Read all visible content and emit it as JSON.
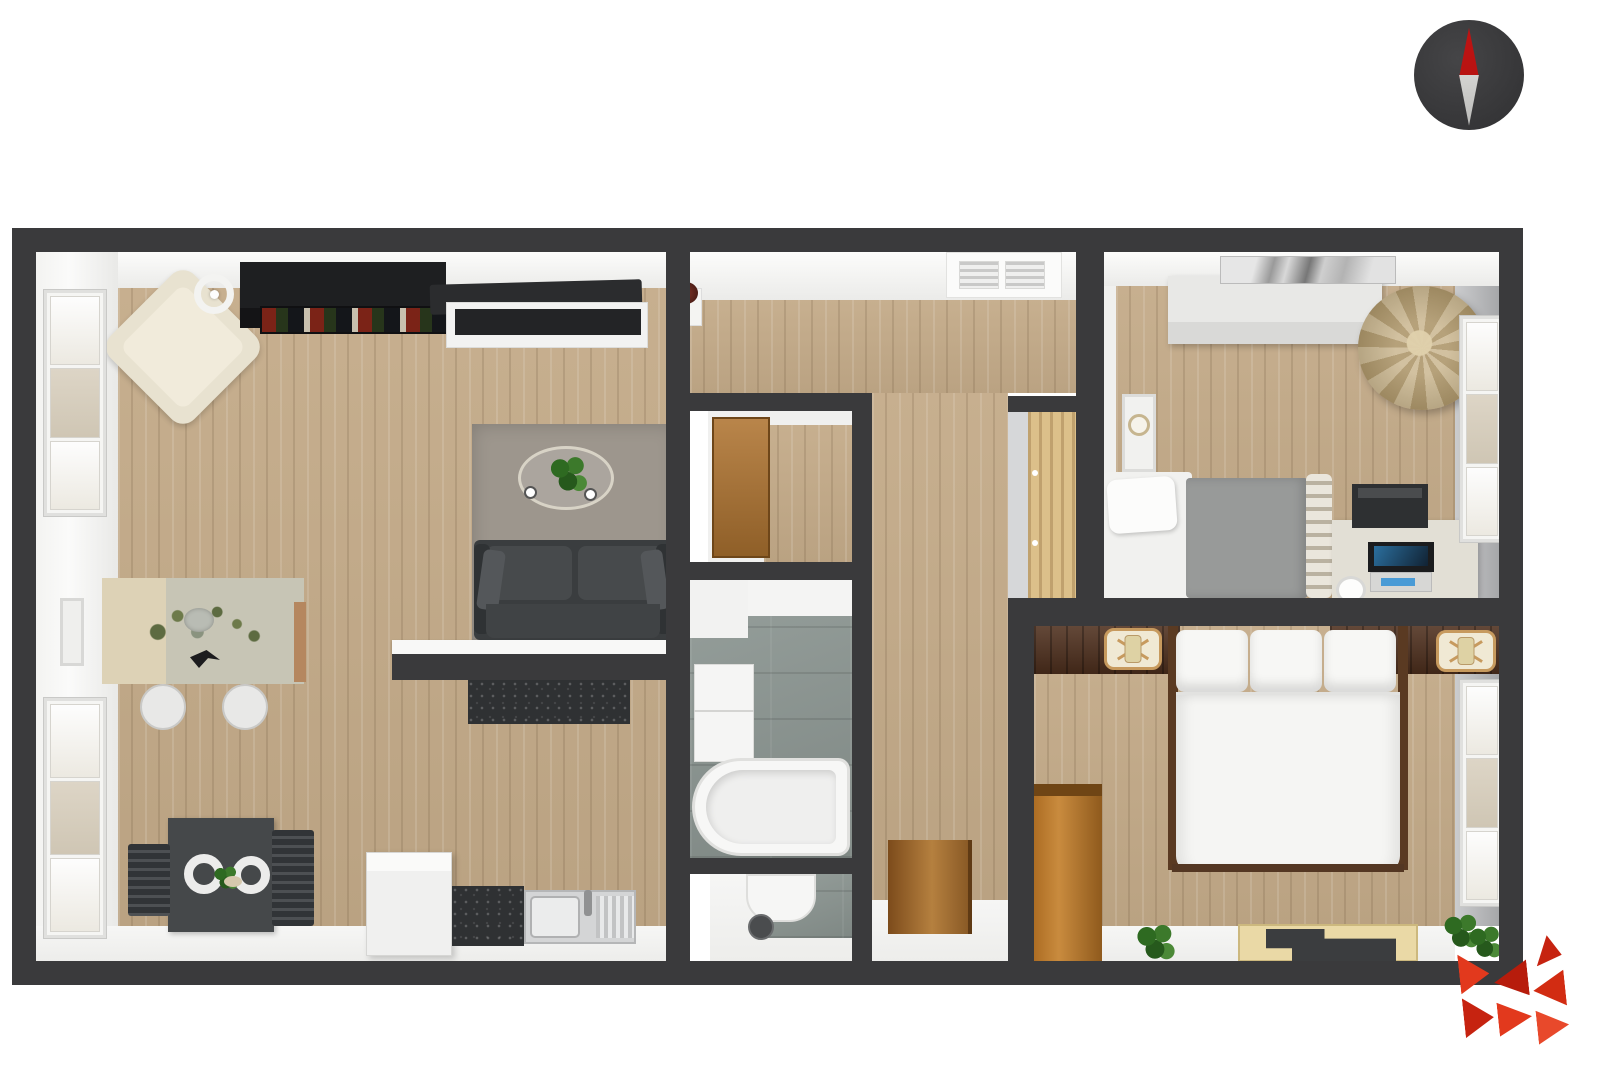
{
  "scene": {
    "description": "3D rendered top-down floor plan of a two-bedroom apartment, no text labels",
    "background_color": "#ffffff"
  },
  "palette": {
    "wall": "#3a3a3c",
    "wood": "#c4ab89",
    "tile": "#8d9793",
    "rug": "#9d968d",
    "sofa": "#3a3d3f",
    "cream": "#e8e2d0",
    "granite": "#2f3133",
    "nightstand": "#4e2f1d",
    "duvet": "#f5f5f3",
    "bean": "#9e8a61",
    "door-wood": "#a9763b",
    "accent-red": "#e2391d",
    "logo-dark": "#b71c0c",
    "compass-red": "#b01311",
    "compass-body": "#3a3a3c",
    "compass-south": "#d9d9d7"
  },
  "compass": {
    "body": "#3a3a3c",
    "north_needle": "#b01311",
    "south_needle": "#d9d9d7"
  },
  "logo": {
    "primary": "#e2391d",
    "dark": "#b71c0c"
  },
  "rooms": [
    {
      "id": "living-room",
      "furniture": [
        "armchair",
        "floor-lamp",
        "bookshelf",
        "tv",
        "tv-stand",
        "plant-stand",
        "area-rug",
        "coffee-table",
        "coffee-table-plant",
        "coffee-cups",
        "sofa",
        "breakfast-bar",
        "console-desk",
        "flower-vase",
        "bird-decor",
        "desk-chairs",
        "picture-frame",
        "windows"
      ]
    },
    {
      "id": "kitchen",
      "furniture": [
        "dining-table",
        "dining-chairs",
        "plates",
        "refrigerator",
        "granite-counter",
        "sink-unit"
      ]
    },
    {
      "id": "hallway",
      "furniture": [
        "ceiling-vent",
        "entry-door",
        "hall-wardrobe"
      ]
    },
    {
      "id": "closet",
      "furniture": [
        "wooden-door"
      ]
    },
    {
      "id": "bathroom",
      "furniture": [
        "bathtub",
        "vanity-cabinet",
        "shower-tray"
      ]
    },
    {
      "id": "wc",
      "furniture": [
        "toilet",
        "floor-drain"
      ]
    },
    {
      "id": "bedroom-1",
      "furniture": [
        "dresser",
        "art-print",
        "bean-bag",
        "wall-clock",
        "single-bed",
        "spindle-headboard",
        "study-desk",
        "printer",
        "laptop",
        "cup",
        "window"
      ]
    },
    {
      "id": "bedroom-2",
      "furniture": [
        "double-bed",
        "pillows",
        "nightstand-left",
        "nightstand-right",
        "table-lamps",
        "wardrobe",
        "floor-tray",
        "plants",
        "window"
      ]
    }
  ]
}
